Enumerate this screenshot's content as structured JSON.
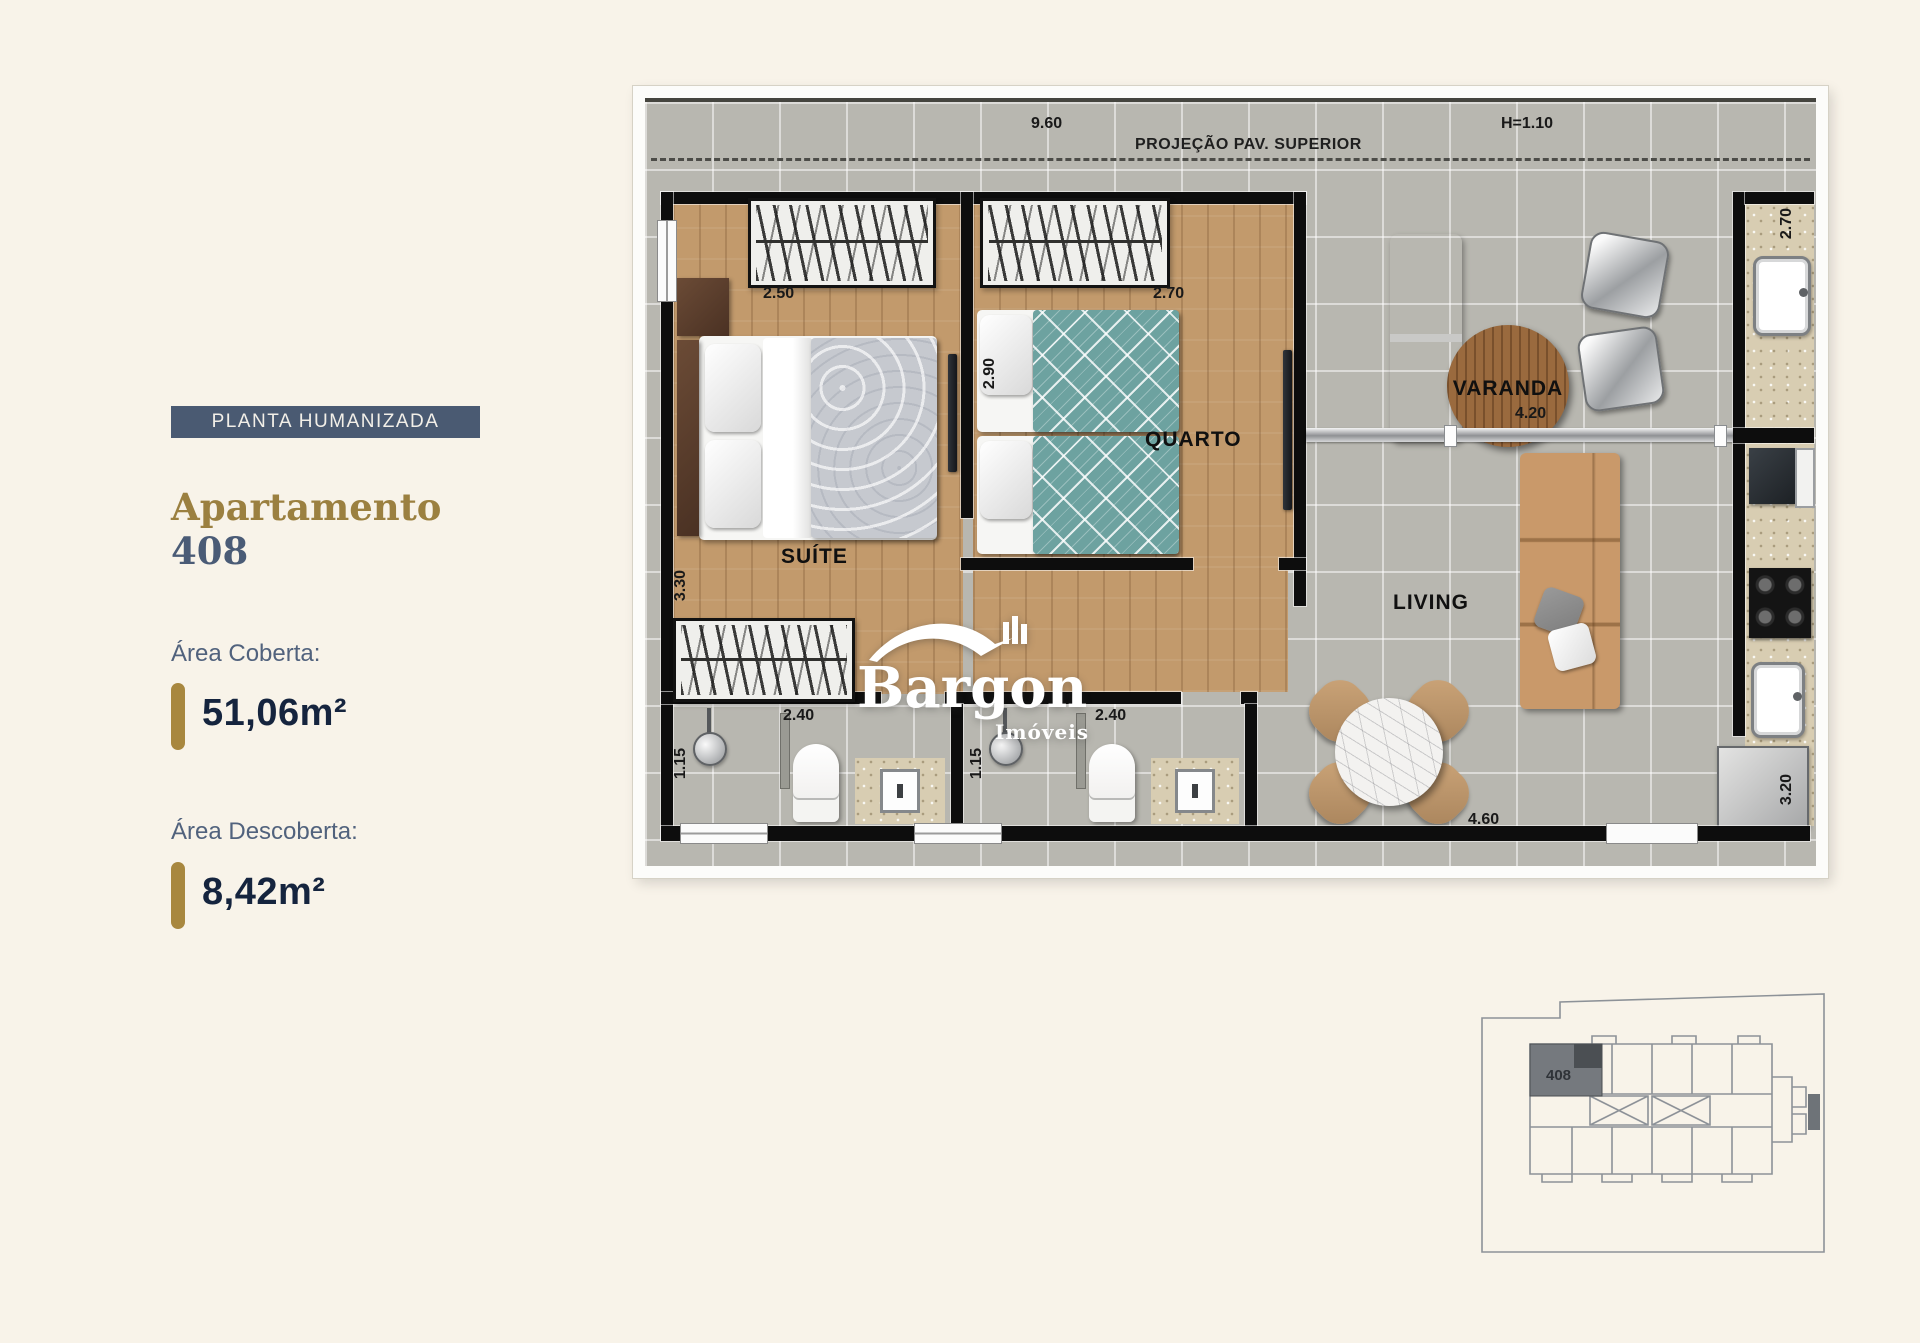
{
  "page": {
    "background": "#f8f3e9"
  },
  "sidebar": {
    "badge": "PLANTA HUMANIZADA",
    "title": "Apartamento",
    "unit_number": "408",
    "covered_area_label": "Área Coberta:",
    "covered_area_value": "51,06m²",
    "open_area_label": "Área Descoberta:",
    "open_area_value": "8,42m²",
    "accent_gold": "#a8873f",
    "badge_bg": "#4a5a72",
    "navy": "#15243e",
    "slate": "#51627d"
  },
  "plan": {
    "projection_label": "PROJEÇÃO PAV. SUPERIOR",
    "rooms": {
      "suite": "SUÍTE",
      "quarto": "QUARTO",
      "living": "LIVING",
      "varanda": "VARANDA"
    },
    "dims": {
      "terrace_width": "9.60",
      "parapet_height": "H=1.10",
      "suite_width": "2.50",
      "suite_depth": "3.30",
      "quarto_width": "2.70",
      "quarto_depth": "2.90",
      "bath1_width": "2.40",
      "bath1_depth": "1.15",
      "bath2_width": "2.40",
      "bath2_depth": "1.15",
      "varanda_width": "4.20",
      "living_width": "4.60",
      "kitchen_top_depth": "2.70",
      "kitchen_bottom_depth": "3.20"
    }
  },
  "watermark": {
    "brand": "Bargon",
    "sub": "Imóveis"
  },
  "keyplan": {
    "unit": "408"
  }
}
